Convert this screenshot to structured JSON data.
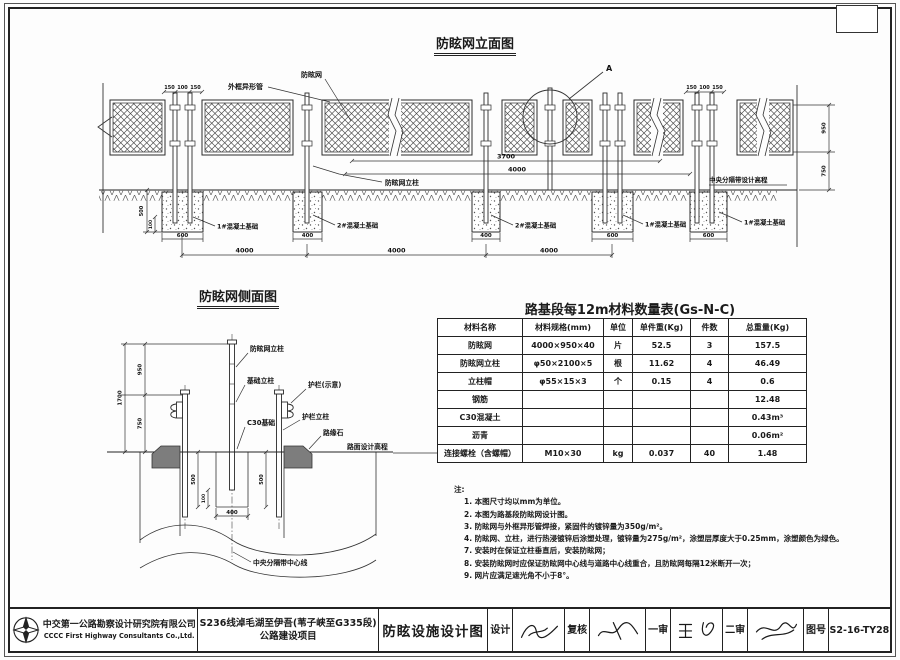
{
  "elevation": {
    "title": "防眩网立面图",
    "labels": {
      "outer_frame": "外框异形管",
      "net": "防眩网",
      "net_post": "防眩网立柱",
      "median_design_elevation": "中央分隔带设计高程",
      "foundation_1": "1#混凝土基础",
      "foundation_2": "2#混凝土基础",
      "detail_a": "A"
    },
    "dims": {
      "d150": "150",
      "d100": "100",
      "d3700": "3700",
      "d4000": "4000",
      "d600": "600",
      "d400": "400",
      "d950": "950",
      "d750": "750",
      "d500": "500",
      "d100v": "100"
    }
  },
  "side": {
    "title": "防眩网侧面图",
    "labels": {
      "net_post": "防眩网立柱",
      "foundation_post": "基础立柱",
      "guardrail": "护栏(示意)",
      "guardrail_post": "护栏立柱",
      "c30_foundation": "C30基础",
      "curb": "路缘石",
      "pavement_design_elevation": "路面设计高程",
      "median_centerline": "中央分隔带中心线"
    },
    "dims": {
      "d1700": "1700",
      "d950": "950",
      "d750": "750",
      "d400": "400",
      "d100": "100",
      "d500": "500"
    }
  },
  "table": {
    "title": "路基段每12m材料数量表(Gs-N-C)",
    "headers": [
      "材料名称",
      "材料规格(mm)",
      "单位",
      "单件重(Kg)",
      "件数",
      "总重量(Kg)"
    ],
    "rows": [
      [
        "防眩网",
        "4000×950×40",
        "片",
        "52.5",
        "3",
        "157.5"
      ],
      [
        "防眩网立柱",
        "φ50×2100×5",
        "根",
        "11.62",
        "4",
        "46.49"
      ],
      [
        "立柱帽",
        "φ55×15×3",
        "个",
        "0.15",
        "4",
        "0.6"
      ],
      [
        "钢筋",
        "",
        "",
        "",
        "",
        "12.48"
      ],
      [
        "C30混凝土",
        "",
        "",
        "",
        "",
        "0.43m³"
      ],
      [
        "沥青",
        "",
        "",
        "",
        "",
        "0.06m²"
      ],
      [
        "连接螺栓（含螺帽）",
        "M10×30",
        "kg",
        "0.037",
        "40",
        "1.48"
      ]
    ]
  },
  "notes": {
    "title": "注:",
    "items": [
      "1. 本图尺寸均以mm为单位。",
      "2. 本图为路基段防眩网设计图。",
      "3. 防眩网与外框异形管焊接，紧固件的镀锌量为350g/m²。",
      "4. 防眩网、立柱，进行热浸镀锌后涂塑处理，镀锌量为275g/m²，涂塑层厚度大于0.25mm，涂塑颜色为绿色。",
      "7. 安装时在保证立柱垂直后，安装防眩网；",
      "8. 安装防眩网时应保证防眩网中心线与道路中心线重合，且防眩网每隔12米断开一次；",
      "9. 网片应满足遮光角不小于8°。"
    ]
  },
  "titleblock": {
    "company_cn": "中交第一公路勘察设计研究院有限公司",
    "company_en": "CCCC First Highway Consultants Co.,Ltd.",
    "project_line1": "S236线淖毛湖至伊吾(苇子峡至G335段)",
    "project_line2": "公路建设项目",
    "drawing_title": "防眩设施设计图",
    "fields": {
      "design_label": "设计",
      "review_label": "复核",
      "first_audit_label": "一审",
      "second_audit_label": "二审",
      "drawing_no_label": "图号",
      "drawing_no": "S2-16-TY28"
    }
  }
}
